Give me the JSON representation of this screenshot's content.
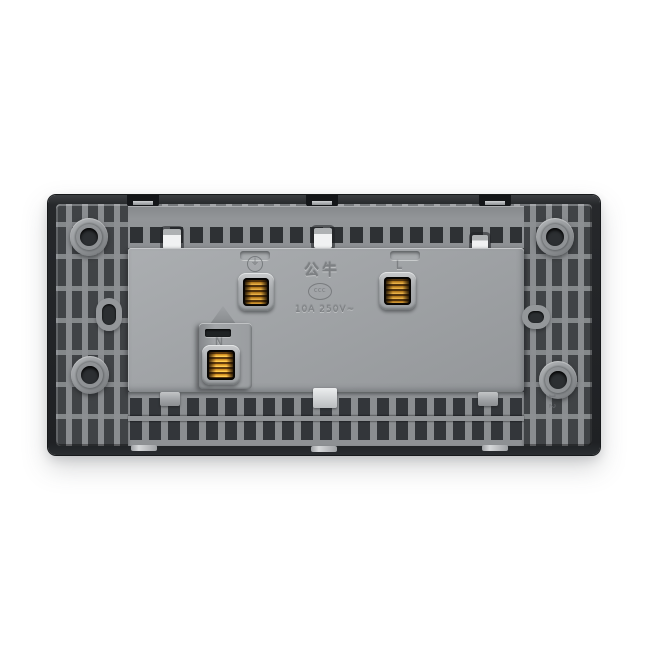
{
  "product": {
    "brand": "公牛",
    "certification_mark": "CCC",
    "rating": "10A 250V~",
    "mold_mark": "1-2",
    "terminals": {
      "earth_symbol": "⏚",
      "live": "L",
      "neutral": "N"
    }
  },
  "colors": {
    "background": "#ffffff",
    "frame_dark": "#232527",
    "rib_gray": "#8a8d90",
    "recess_dark": "#3e4145",
    "plate_gray": "#a2a5a8",
    "bezel_gray": "#b5b8ba",
    "brass": "#c08427"
  }
}
